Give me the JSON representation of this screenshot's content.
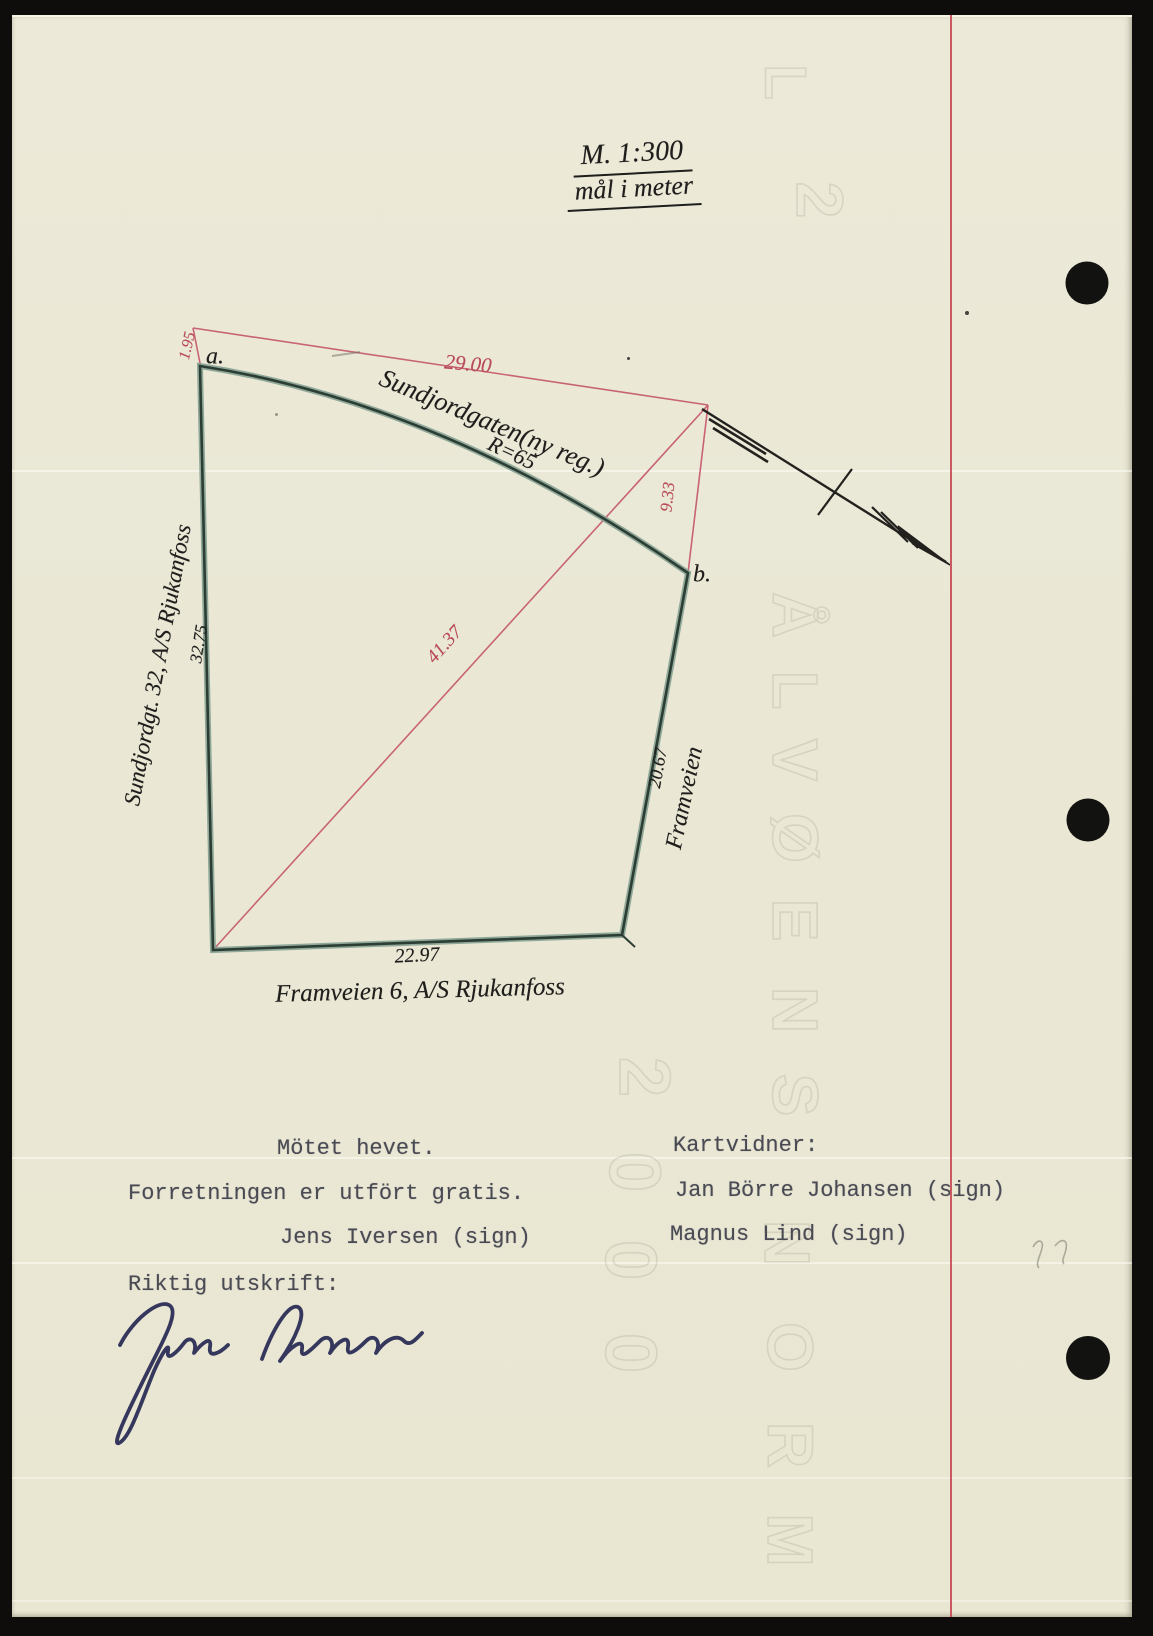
{
  "colors": {
    "paper": "#eae8d5",
    "margin_line_red": "#c4414d",
    "measurement_red": "#b84a57",
    "boundary_green": "#3c5349",
    "handwriting_ink": "#1f1e1c",
    "typewriter_ink": "#4a4a54",
    "signature_ink": "#2b2d55"
  },
  "scale": {
    "line1": "M. 1:300",
    "line2": "mål i meter"
  },
  "plot": {
    "point_a": "a.",
    "point_b": "b.",
    "street_top": "Sundjordgaten(ny reg.)",
    "street_top_radius": "R=65",
    "street_right": "Framveien",
    "measure_top": "29.00",
    "measure_offset_a": "1.95",
    "measure_offset_b": "9.33",
    "measure_diagonal": "41.37",
    "measure_left": "32.75",
    "measure_right": "20.67",
    "measure_bottom": "22.97",
    "parcel_left": "Sundjordgt. 32, A/S Rjukanfoss",
    "parcel_bottom": "Framveien 6, A/S Rjukanfoss"
  },
  "minutes": {
    "line_meeting": "Mötet hevet.",
    "line_gratis": "Forretningen er utfört gratis.",
    "line_surveyor": "Jens Iversen (sign)",
    "heading_witnesses": "Kartvidner:",
    "witness1": "Jan Börre Johansen (sign)",
    "witness2": "Magnus Lind (sign)",
    "line_certify": "Riktig utskrift:"
  },
  "watermark": {
    "top": [
      "L",
      "2"
    ],
    "name_column": [
      "Å",
      "L",
      "V",
      "Ø",
      "E",
      "N",
      "S"
    ],
    "number_column": [
      "2",
      "0",
      "0",
      "0"
    ],
    "lower_column": [
      "N",
      "O",
      "R",
      "M"
    ]
  }
}
